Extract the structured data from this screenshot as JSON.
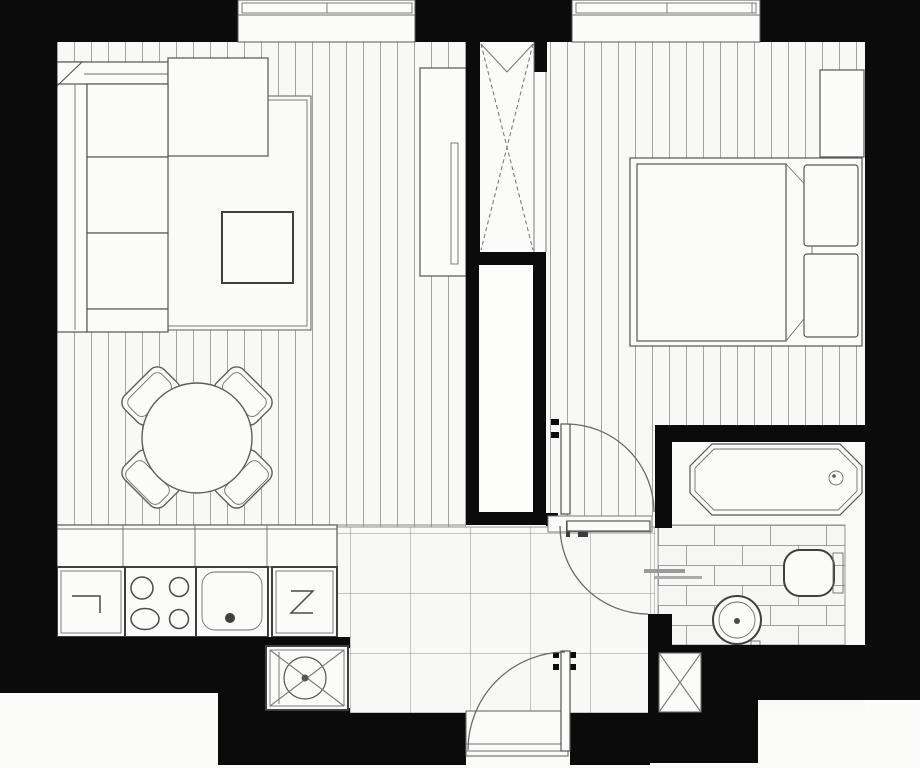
{
  "document": {
    "type": "apartment-floor-plan",
    "style": "black-and-white architectural drawing, top-down view",
    "visible_text": []
  },
  "colors": {
    "walls": "#0b0b0b",
    "paper": "#fbfbfa",
    "furniture_fill": "#fbfbfa",
    "line": "#565656",
    "plank_line": "#a3a3a3",
    "tile_line": "#8f8f8f",
    "brick_line": "#9f9f9f"
  },
  "floorplan": {
    "rooms": [
      {
        "name": "living-room",
        "floor": "wood-planks-vertical",
        "items": [
          "corner-sofa",
          "area-rug",
          "coffee-table",
          "round-dining-table",
          "four-chairs",
          "tall-wardrobe"
        ]
      },
      {
        "name": "bedroom",
        "floor": "wood-planks-vertical",
        "items": [
          "double-bed-with-two-pillows",
          "blanket-fold",
          "dresser"
        ]
      },
      {
        "name": "bathroom",
        "floor": "brick-pattern-tile",
        "items": [
          "bathtub-with-drain",
          "toilet",
          "round-pedestal-sink",
          "bath-mat"
        ]
      },
      {
        "name": "kitchen",
        "floor": "square-tiles",
        "items": [
          "counter-unit",
          "stove-four-burners",
          "kitchen-sink",
          "dishwasher",
          "washing-machine",
          "upper-cabinet-row"
        ]
      },
      {
        "name": "hallway",
        "floor": "square-tiles",
        "items": [
          "entrance-door-swing",
          "bedroom-door-swing",
          "bathroom-door-swing",
          "threshold"
        ]
      }
    ],
    "architecture": [
      "two-top-windows",
      "built-in-closet-with-x-cross",
      "ventilation-shaft",
      "bathroom-corner-shaft-with-x",
      "thick-exterior-walls",
      "notched-bottom-corners"
    ]
  }
}
